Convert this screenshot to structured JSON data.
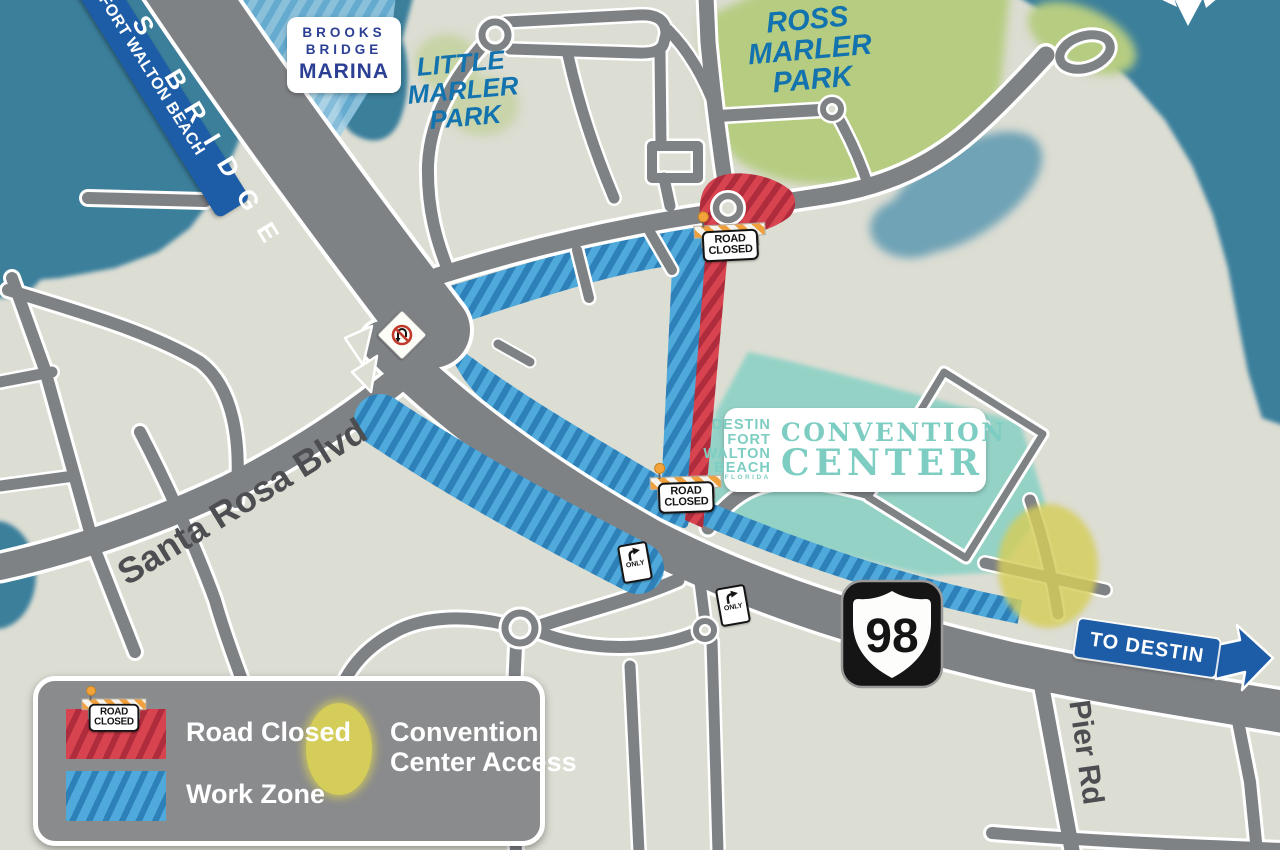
{
  "labels": {
    "bridge": "S BRIDGE",
    "fort_walton_banner": "FORT WALTON BEACH",
    "marina": {
      "l1": "BROOKS",
      "l2": "BRIDGE",
      "l3": "MARINA"
    },
    "little_marler": {
      "l1": "LITTLE",
      "l2": "MARLER",
      "l3": "PARK"
    },
    "ross_marler": {
      "l1": "ROSS",
      "l2": "MARLER",
      "l3": "PARK"
    },
    "santa_rosa": "Santa Rosa Blvd",
    "pier_rd": "Pier Rd",
    "to_destin": "TO DESTIN",
    "route_98": "98",
    "convention_logo": {
      "l1": "DESTIN",
      "l2": "FORT",
      "l3": "WALTON",
      "l4": "BEACH",
      "l5": "FLORIDA",
      "r1": "CONVENTION",
      "r2": "CENTER"
    }
  },
  "signs": {
    "road_closed": {
      "l1": "ROAD",
      "l2": "CLOSED"
    },
    "turn_only": "ONLY"
  },
  "legend": {
    "road_closed": "Road Closed",
    "work_zone": "Work Zone",
    "access_l1": "Convention",
    "access_l2": "Center Access"
  },
  "colors": {
    "water": "#3a7f9b",
    "land": "#dcddd3",
    "road": "#7f8285",
    "work_zone": "#4fa9da",
    "work_zone_stripe": "#2d80b8",
    "road_closed": "#d84350",
    "road_closed_stripe": "#ae2c3c",
    "access_oval": "#d5cd5a",
    "park_green": "#b6cc81",
    "convention_area": "#8fd2c6",
    "banner_blue": "#1d5ca7"
  }
}
